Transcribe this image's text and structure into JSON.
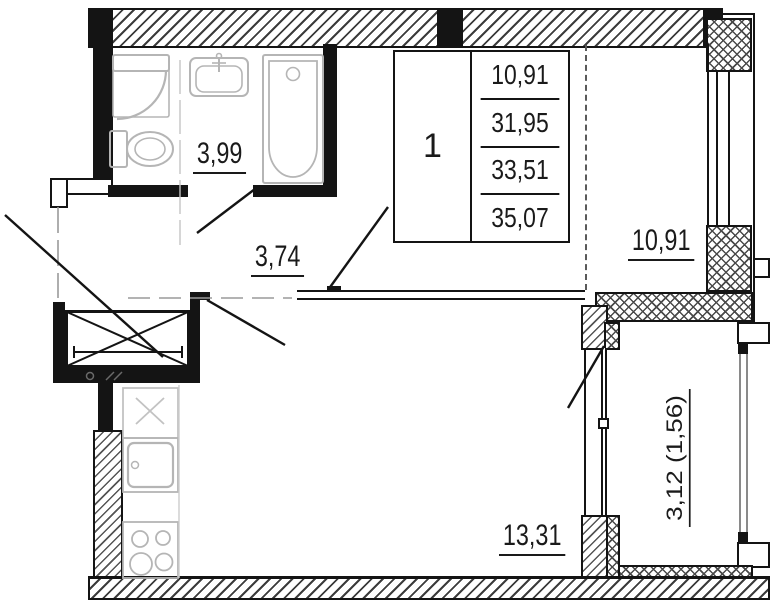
{
  "info_table": {
    "apartment_number": "1",
    "areas": [
      "10,91",
      "31,95",
      "33,51",
      "35,07"
    ]
  },
  "rooms": {
    "bathroom": {
      "area_label": "3,99"
    },
    "hallway": {
      "area_label": "3,74"
    },
    "living_room": {
      "area_label": "10,91"
    },
    "kitchen_living": {
      "area_label": "13,31"
    },
    "balcony": {
      "area_label": "3,12 (1,56)"
    }
  },
  "colors": {
    "wall": "#141414",
    "fixture_gray": "#b5b5b5",
    "glazing_gray": "#8a8a8a",
    "guide_gray": "#9a9a9a"
  }
}
